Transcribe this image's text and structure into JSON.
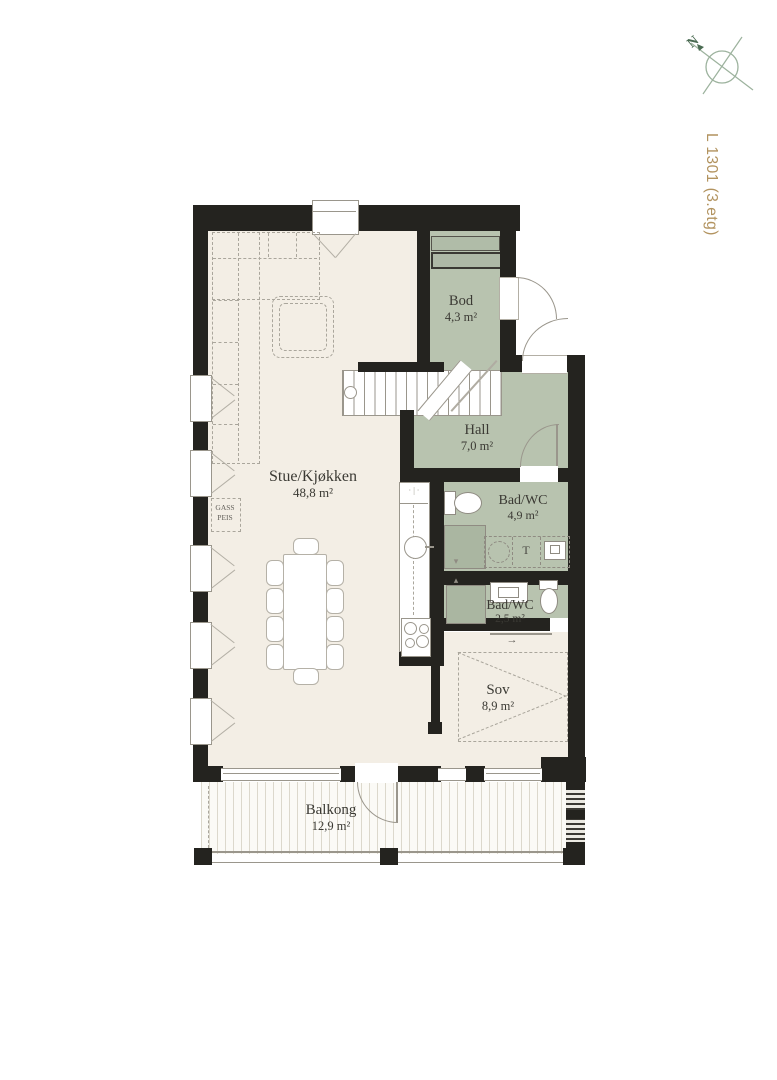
{
  "meta": {
    "unit_label": "L 1301 (3.etg)",
    "compass_north": "N"
  },
  "rooms": {
    "stue": {
      "name": "Stue/Kjøkken",
      "area": "48,8 m²"
    },
    "bod": {
      "name": "Bod",
      "area": "4,3 m²"
    },
    "hall": {
      "name": "Hall",
      "area": "7,0 m²"
    },
    "bad1": {
      "name": "Bad/WC",
      "area": "4,9 m²"
    },
    "bad2": {
      "name": "Bad/WC",
      "area": "2,5 m²"
    },
    "sov": {
      "name": "Sov",
      "area": "8,9 m²"
    },
    "balkong": {
      "name": "Balkong",
      "area": "12,9 m²"
    }
  },
  "annotations": {
    "fireplace_line1": "GASS",
    "fireplace_line2": "PEIS",
    "dryer": "T",
    "slide_arrow": "→",
    "vent_down": "▾",
    "vent_up": "▴"
  },
  "colors": {
    "wall": "#24231f",
    "room_cream": "#f3eee5",
    "room_green": "#b8c3af",
    "balcony_bg": "#fbfaf6",
    "accent_label": "#b2935f",
    "compass": "#9cb29d",
    "compass_dark": "#4a6b52",
    "ink": "#3b3a34"
  }
}
